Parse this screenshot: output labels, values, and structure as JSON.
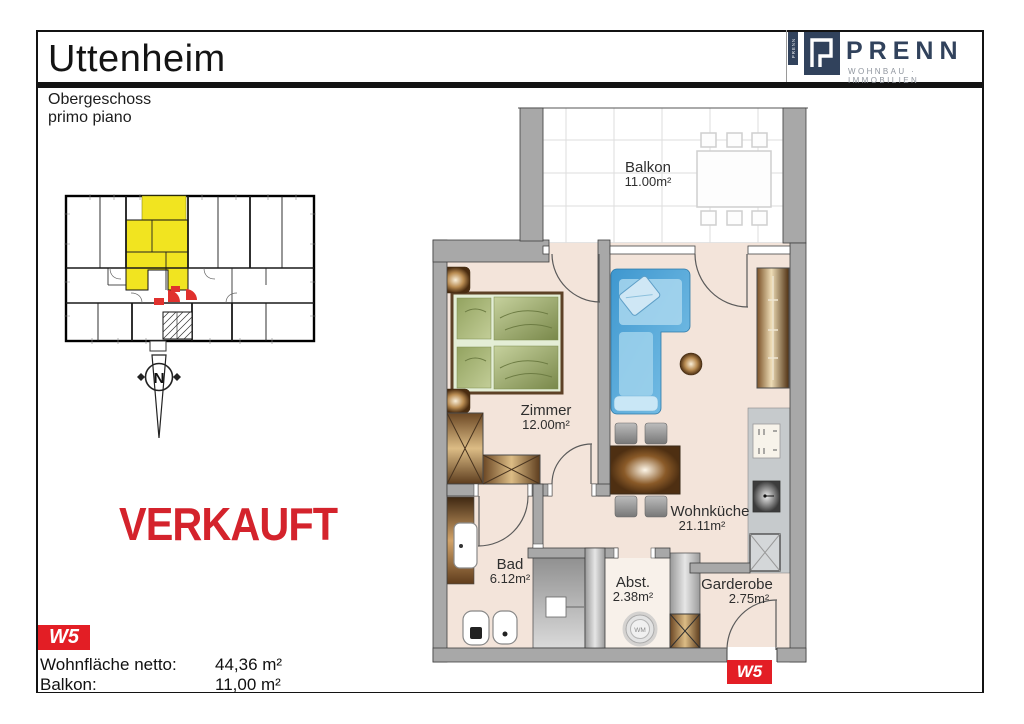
{
  "header": {
    "title": "Uttenheim",
    "subtitle_de": "Obergeschoss",
    "subtitle_it": "primo piano"
  },
  "brand": {
    "name": "PRENN",
    "tagline": "WOHNBAU · IMMOBILIEN",
    "vertical_text": "PRENN"
  },
  "status": {
    "stamp": "VERKAUFT"
  },
  "unit": {
    "id": "W5"
  },
  "summary": {
    "rows": [
      {
        "label": "Wohnfläche netto:",
        "value": "44,36 m²"
      },
      {
        "label": "Balkon:",
        "value": "11,00 m²"
      }
    ]
  },
  "compass": {
    "letter": "N"
  },
  "rooms": [
    {
      "name": "Balkon",
      "area": "11.00m²"
    },
    {
      "name": "Zimmer",
      "area": "12.00m²"
    },
    {
      "name": "Wohnküche",
      "area": "21.11m²"
    },
    {
      "name": "Bad",
      "area": "6.12m²"
    },
    {
      "name": "Abst.",
      "area": "2.38m²"
    },
    {
      "name": "Garderobe",
      "area": "2.75m²"
    }
  ],
  "appliances": {
    "washing_machine": "WM"
  },
  "colors": {
    "accent-red": "#e31e25",
    "sold-red": "#d4232c",
    "brand-navy": "#31425c",
    "brand-gray": "#8f959e",
    "highlight-yellow": "#f1e420",
    "floor-pink": "#f3e4da",
    "wall-gray": "#a8a8a8"
  }
}
